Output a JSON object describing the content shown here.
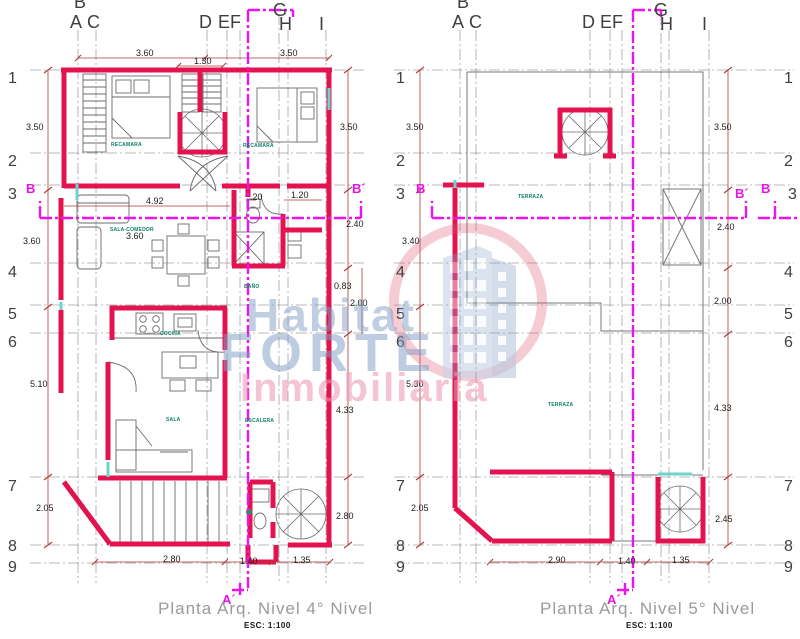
{
  "colors": {
    "wall_red": "#e3134f",
    "section_magenta": "#ec13ec",
    "dim_red": "#b03a3a",
    "line_gray": "#777777",
    "room_teal": "#0b7f66",
    "caption_gray": "#9b9b9b",
    "accent_cyan": "#6ed3cc",
    "watermark_blue": "#829ec6",
    "watermark_pink": "#ec94b0"
  },
  "watermark": {
    "word1": "Habitat",
    "word2": "FORTE",
    "word3": "Inmobiliaria"
  },
  "axes": [
    "B",
    "A",
    "C",
    "D",
    "E",
    "F",
    "G",
    "H",
    "I"
  ],
  "rows": [
    "1",
    "2",
    "3",
    "4",
    "5",
    "6",
    "7",
    "8",
    "9"
  ],
  "plan4": {
    "caption": "Planta  Arq. Nivel  4° Nivel",
    "scale": "ESC: 1:100",
    "dims": {
      "left": [
        "3.50",
        "3.60",
        "5.10",
        "2.05"
      ],
      "right": [
        "3.50",
        "2.40",
        "0.83",
        "2.00",
        "4.33",
        "2.80"
      ],
      "top": [
        "3.60",
        "1.30",
        "3.50"
      ],
      "bottom": [
        "2.80",
        "1.40",
        "1.35"
      ],
      "inner": [
        "4.92",
        ".20",
        "1.20",
        "3.60"
      ]
    },
    "rooms": {
      "bedroom_left": "RECAMARA",
      "bedroom_right": "RECAMARA",
      "sala_comedor": "SALA-COMEDOR",
      "bath": "BAÑO",
      "kitchen": "COCINA",
      "sala": "SALA",
      "stairs": "ESCALERA"
    },
    "marks": {
      "b": "B",
      "b_prime": "B´",
      "a_prime": "A´"
    }
  },
  "plan5": {
    "caption": "Planta  Arq. Nivel  5° Nivel",
    "scale": "ESC: 1:100",
    "dims": {
      "left": [
        "3.50",
        "3.40",
        "5.30",
        "2.05"
      ],
      "right": [
        "3.50",
        "2.40",
        "2.00",
        "4.33",
        "2.45"
      ],
      "bottom": [
        "2.90",
        "1.40",
        "1.35"
      ]
    },
    "rooms": {
      "terraza_upper": "TERRAZA",
      "terraza_lower": "TERRAZA"
    },
    "marks": {
      "b": "B",
      "b_prime": "B´",
      "b_edge": "B",
      "a_prime": "A´"
    }
  }
}
